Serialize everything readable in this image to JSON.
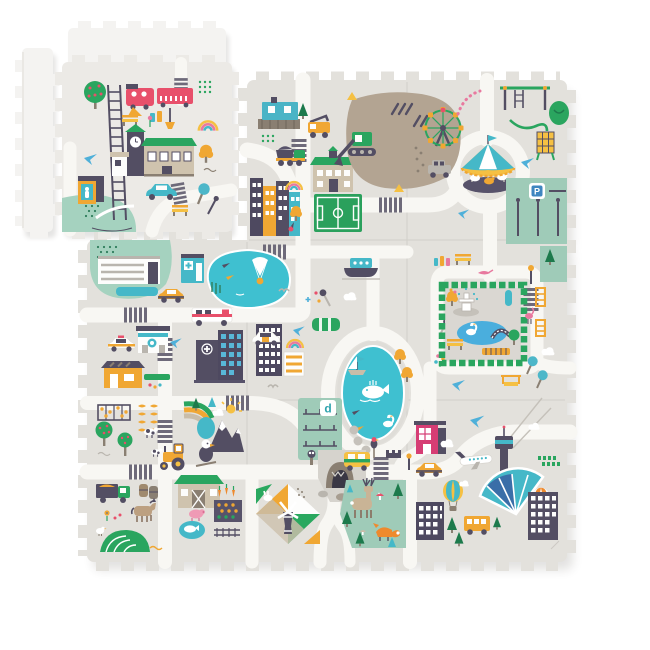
{
  "scene": {
    "type": "product photo",
    "subject": "children's interlocking foam puzzle play mat printed with a city road map",
    "background_color": "#ffffff"
  },
  "signs": {
    "parking": "P",
    "district": "d"
  },
  "palette": {
    "mat_gray": "#e3e1dc",
    "road_white": "#f8f7f3",
    "plain_foam": "#f4f3f1",
    "water_teal": "#3fc0d0",
    "mint_sage": "#a0ccb9",
    "grass_green": "#2aa55f",
    "dark_pine": "#1d7a4c",
    "amber_yellow": "#f0a733",
    "warm_yellow": "#f5c043",
    "train_red": "#e8506b",
    "shop_magenta": "#d63d74",
    "slate_dark": "#534e63",
    "building_tan": "#cfc3ae",
    "construction_tan": "#b3a492",
    "sky_blue": "#4fb0d9",
    "parking_sign_blue": "#3f86c0",
    "stripe_dark": "#6e6a7a"
  },
  "pieces": {
    "mat_grid": "3x3 interlocked tiles, top-left tile removed",
    "loose": [
      "plain-foam-strip-piece",
      "plain-foam-piece",
      "train-station-tile"
    ]
  },
  "landmarks": {
    "station_tile": [
      "apple-tree",
      "train",
      "railway-ladder",
      "taxi",
      "bench",
      "jars",
      "hanging-lamp",
      "crosswalk",
      "dotted-square",
      "rainbow",
      "clock-tower",
      "station-hall",
      "yellow-tree",
      "blue-bird",
      "phone-booth",
      "mint-lawn",
      "teal-car",
      "crosswalk",
      "bench",
      "teal-topiary",
      "street-lamp"
    ],
    "top_middle": [
      "apartment-row",
      "rainbow",
      "soccer-field",
      "school",
      "site-cabin",
      "crane-truck",
      "dump-truck",
      "construction-pit",
      "excavator",
      "cones",
      "ferris-wheel",
      "garland"
    ],
    "top_right": [
      "roundabout",
      "carousel",
      "swing-frame",
      "climbing-wall",
      "bush",
      "slide-hose",
      "parking-lot",
      "parking-sign",
      "lamp-posts",
      "suv",
      "paper-plane-birds"
    ],
    "mid_left": [
      "mint-plaza",
      "mall-building",
      "pharmacy-kiosk",
      "taxi",
      "pond-with-parachute",
      "ambulance",
      "hospital",
      "optician-shop",
      "police-car",
      "yellow-shop",
      "skyscrapers",
      "rainbow",
      "gull"
    ],
    "center": [
      "canal-boat",
      "top-view-car",
      "wagon-car",
      "stars",
      "lake",
      "sail-boat",
      "whale",
      "swan",
      "stepping-stones",
      "garden-plot",
      "district-sign",
      "yellow-trees",
      "flowers"
    ],
    "mid_right": [
      "hedge-park",
      "fountain",
      "swan-pond",
      "foot-bridge",
      "benches",
      "boardwalk",
      "flamingos",
      "ladders",
      "tilted-topiaries",
      "hanging-bench",
      "sage-blocks"
    ],
    "bottom_left": [
      "grape-trellis",
      "corn-rows",
      "apple-trees",
      "cows",
      "mountains",
      "rainbow",
      "sun",
      "eagle",
      "tractor",
      "farm-truck",
      "barrels",
      "barn",
      "pig",
      "vegetable-garden",
      "carrots",
      "horse",
      "chickens",
      "crop-hill",
      "whale-puddle",
      "rail-piece"
    ],
    "bottom_middle": [
      "harlequin-field",
      "windmill",
      "rabbit",
      "cave",
      "rocks",
      "owl",
      "forest",
      "deer",
      "fox",
      "mushrooms",
      "pines",
      "camper-van",
      "parrot",
      "fort"
    ],
    "bottom_right": [
      "magenta-shop",
      "taxi",
      "airplane",
      "control-tower",
      "contrails",
      "airport-terminal",
      "hot-air-balloons",
      "school-bus",
      "city-buildings",
      "pines",
      "clouds",
      "hedge-row"
    ]
  }
}
